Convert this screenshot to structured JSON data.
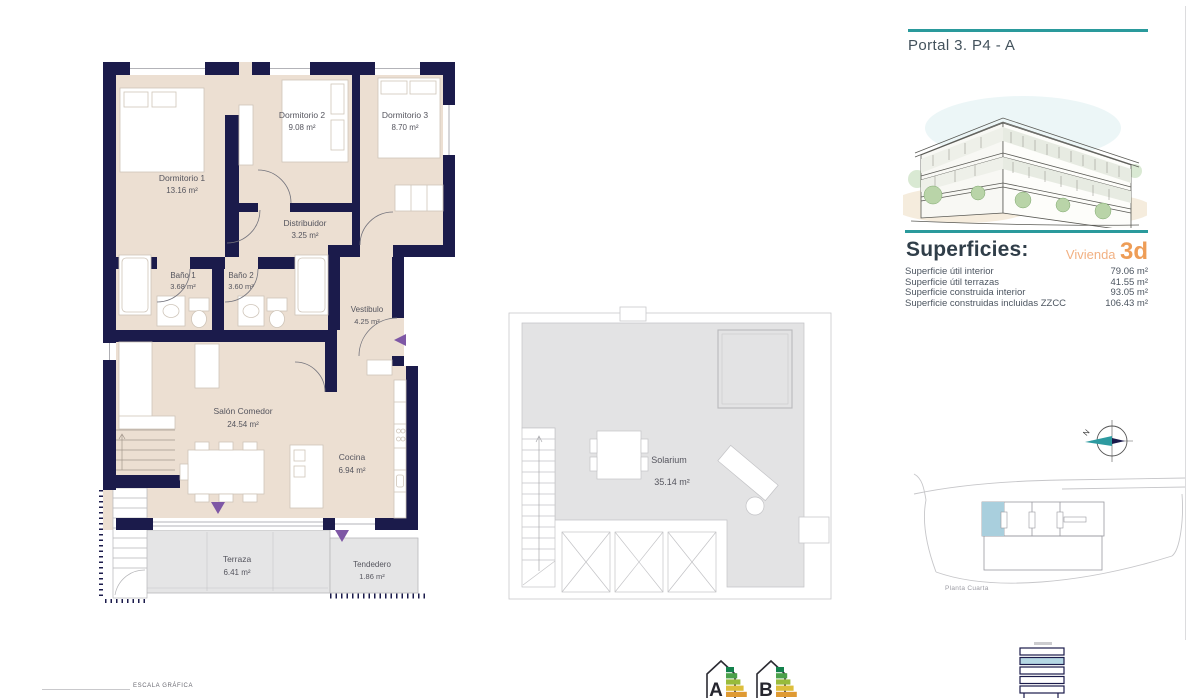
{
  "panel": {
    "portal_title": "Portal 3. P4 - A",
    "superficies_title": "Superficies:",
    "vivienda_label": "Vivienda",
    "vivienda_code": "3d",
    "rows": [
      {
        "label": "Superficie útil interior",
        "value": "79.06 m²"
      },
      {
        "label": "Superficie útil terrazas",
        "value": "41.55 m²"
      },
      {
        "label": "Superficie construida interior",
        "value": "93.05 m²"
      },
      {
        "label": "Superficie construidas incluidas ZZCC",
        "value": "106.43 m²"
      }
    ],
    "compass_label": "N",
    "site_caption": "Planta Cuarta"
  },
  "plan": {
    "dorm1": {
      "name": "Dormitorio 1",
      "area": "13.16 m²"
    },
    "dorm2": {
      "name": "Dormitorio 2",
      "area": "9.08 m²"
    },
    "dorm3": {
      "name": "Dormitorio 3",
      "area": "8.70 m²"
    },
    "distribuidor": {
      "name": "Distribuidor",
      "area": "3.25 m²"
    },
    "bano1": {
      "name": "Baño 1",
      "area": "3.68 m²"
    },
    "bano2": {
      "name": "Baño 2",
      "area": "3.60 m²"
    },
    "vestibulo": {
      "name": "Vestibulo",
      "area": "4.25 m²"
    },
    "salon": {
      "name": "Salón Comedor",
      "area": "24.54 m²"
    },
    "cocina": {
      "name": "Cocina",
      "area": "6.94 m²"
    },
    "terraza": {
      "name": "Terraza",
      "area": "6.41 m²"
    },
    "tendedero": {
      "name": "Tendedero",
      "area": "1.86 m²"
    },
    "solarium": {
      "name": "Solarium",
      "area": "35.14 m²"
    }
  },
  "footer": {
    "scale_label": "ESCALA GRÁFICA",
    "energy_labels": [
      "A",
      "B"
    ]
  },
  "colors": {
    "wall_navy": "#1b1b4b",
    "floor_beige": "#ecdfd2",
    "terrace_gray": "#e5e5e6",
    "accent_teal": "#2a9a9c",
    "accent_orange": "#ee9d57",
    "marker_purple": "#7e57a5",
    "highlight_blue": "#a9cfdd"
  }
}
